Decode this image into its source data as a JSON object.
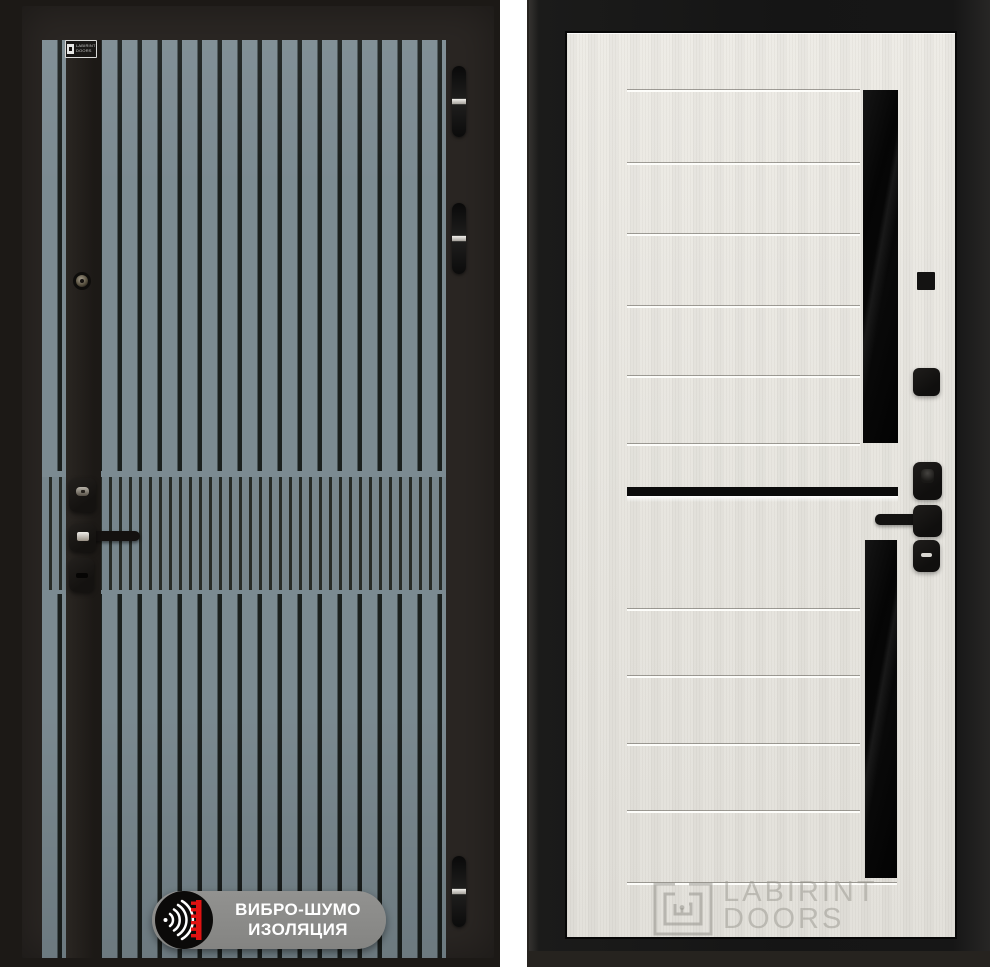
{
  "css_vars": {
    "--stripe": "#7b8a91",
    "--stripe-dk": "#76858c",
    "--stripe-gap": "#1a1f1d",
    "--stripe-gap2": "#262b27",
    "--divider": "#ffffff"
  },
  "scene": {
    "left_door": {
      "description": "dark entry door with vertical teal-grey slats",
      "brand_plate": {
        "line1": "LABIRINT",
        "line2": "DOORS"
      },
      "badge": {
        "line1": "ВИБРО-ШУМО",
        "line2": "ИЗОЛЯЦИЯ",
        "icon": "sound-waves-icon",
        "accent_color": "#e01212",
        "pill_color": "#8d8d8b"
      },
      "hardware": [
        "peephole",
        "lock-cylinder",
        "door-handle",
        "keyhole"
      ],
      "hinge_count": 3
    },
    "right_door": {
      "description": "light interior door panel with black glass inserts",
      "watermark": {
        "brand": "LABIRINT",
        "word": "DOORS",
        "icon": "labyrinth-logo-icon"
      },
      "panel_color": "#e7e5df",
      "frame_color": "#171717",
      "glass_color": "#070707"
    }
  }
}
